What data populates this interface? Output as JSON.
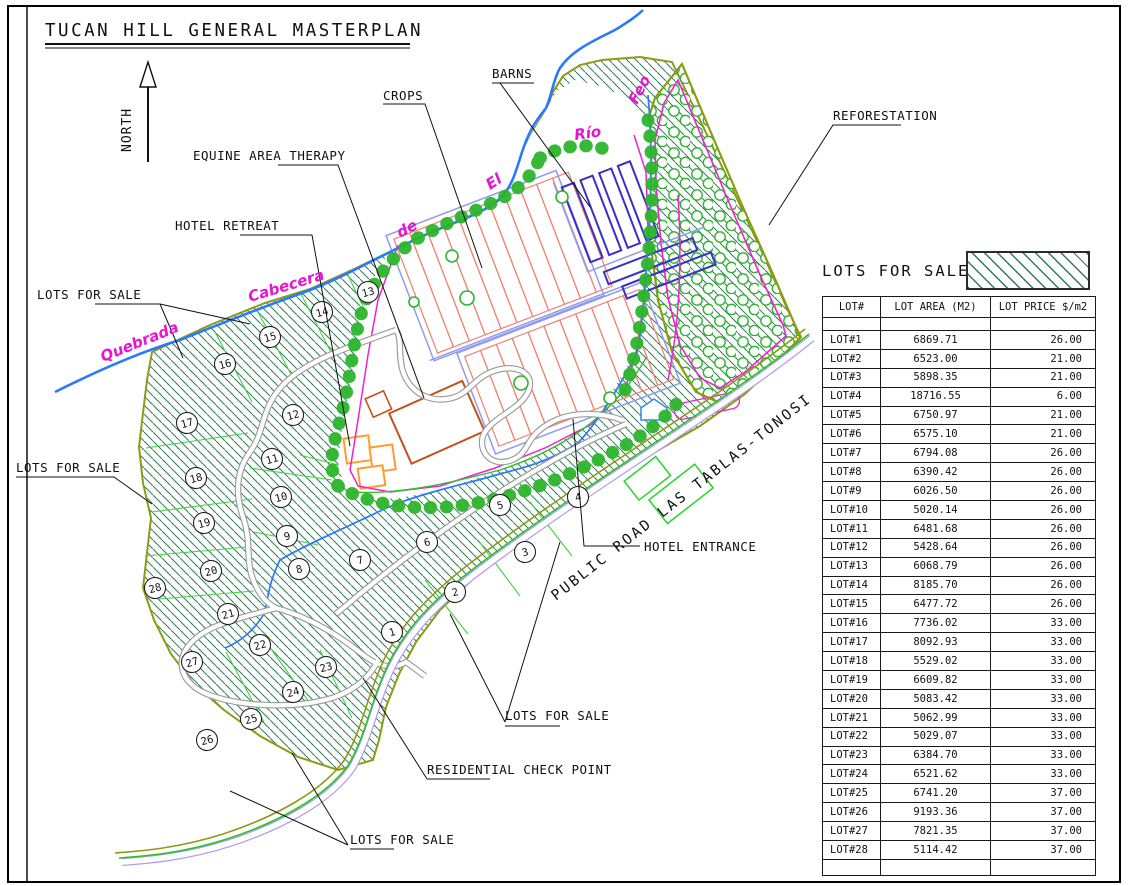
{
  "title": "TUCAN HILL GENERAL MASTERPLAN",
  "map": {
    "north": "NORTH",
    "labels": {
      "crops": "CROPS",
      "barns": "BARNS",
      "equine": "EQUINE AREA THERAPY",
      "hotel_retreat": "HOTEL RETREAT",
      "reforestation": "REFORESTATION",
      "lots_for_sale": "LOTS FOR SALE",
      "residential_check_point": "RESIDENTIAL CHECK POINT",
      "hotel_entrance": "HOTEL ENTRANCE",
      "public_road": "PUBLIC ROAD LAS TABLAS-TONOSI"
    },
    "river_words": {
      "quebrada": "Quebrada",
      "cabecera": "Cabecera",
      "de": "de",
      "el": "El",
      "rio": "Río",
      "feo": "Feo"
    },
    "lot_markers": [
      {
        "n": 1,
        "x": 392,
        "y": 632
      },
      {
        "n": 2,
        "x": 455,
        "y": 592
      },
      {
        "n": 3,
        "x": 525,
        "y": 552
      },
      {
        "n": 4,
        "x": 578,
        "y": 497
      },
      {
        "n": 5,
        "x": 500,
        "y": 505
      },
      {
        "n": 6,
        "x": 427,
        "y": 542
      },
      {
        "n": 7,
        "x": 360,
        "y": 560
      },
      {
        "n": 8,
        "x": 299,
        "y": 569
      },
      {
        "n": 9,
        "x": 287,
        "y": 536
      },
      {
        "n": 10,
        "x": 281,
        "y": 497
      },
      {
        "n": 11,
        "x": 272,
        "y": 459
      },
      {
        "n": 12,
        "x": 293,
        "y": 415
      },
      {
        "n": 13,
        "x": 368,
        "y": 292
      },
      {
        "n": 14,
        "x": 322,
        "y": 312
      },
      {
        "n": 15,
        "x": 270,
        "y": 337
      },
      {
        "n": 16,
        "x": 225,
        "y": 364
      },
      {
        "n": 17,
        "x": 187,
        "y": 423
      },
      {
        "n": 18,
        "x": 196,
        "y": 478
      },
      {
        "n": 19,
        "x": 204,
        "y": 523
      },
      {
        "n": 20,
        "x": 211,
        "y": 571
      },
      {
        "n": 21,
        "x": 228,
        "y": 614
      },
      {
        "n": 22,
        "x": 260,
        "y": 645
      },
      {
        "n": 23,
        "x": 326,
        "y": 667
      },
      {
        "n": 24,
        "x": 293,
        "y": 692
      },
      {
        "n": 25,
        "x": 251,
        "y": 719
      },
      {
        "n": 26,
        "x": 207,
        "y": 740
      },
      {
        "n": 27,
        "x": 192,
        "y": 662
      },
      {
        "n": 28,
        "x": 155,
        "y": 588
      }
    ]
  },
  "legend": {
    "title": "LOTS FOR SALE"
  },
  "table": {
    "columns": [
      "LOT#",
      "LOT AREA (M2)",
      "LOT PRICE $/m2"
    ],
    "rows": [
      {
        "lot": "LOT#1",
        "area": "6869.71",
        "price": "26.00"
      },
      {
        "lot": "LOT#2",
        "area": "6523.00",
        "price": "21.00"
      },
      {
        "lot": "LOT#3",
        "area": "5898.35",
        "price": "21.00"
      },
      {
        "lot": "LOT#4",
        "area": "18716.55",
        "price": "6.00"
      },
      {
        "lot": "LOT#5",
        "area": "6750.97",
        "price": "21.00"
      },
      {
        "lot": "LOT#6",
        "area": "6575.10",
        "price": "21.00"
      },
      {
        "lot": "LOT#7",
        "area": "6794.08",
        "price": "26.00"
      },
      {
        "lot": "LOT#8",
        "area": "6390.42",
        "price": "26.00"
      },
      {
        "lot": "LOT#9",
        "area": "6026.50",
        "price": "26.00"
      },
      {
        "lot": "LOT#10",
        "area": "5020.14",
        "price": "26.00"
      },
      {
        "lot": "LOT#11",
        "area": "6481.68",
        "price": "26.00"
      },
      {
        "lot": "LOT#12",
        "area": "5428.64",
        "price": "26.00"
      },
      {
        "lot": "LOT#13",
        "area": "6068.79",
        "price": "26.00"
      },
      {
        "lot": "LOT#14",
        "area": "8185.70",
        "price": "26.00"
      },
      {
        "lot": "LOT#15",
        "area": "6477.72",
        "price": "26.00"
      },
      {
        "lot": "LOT#16",
        "area": "7736.02",
        "price": "33.00"
      },
      {
        "lot": "LOT#17",
        "area": "8092.93",
        "price": "33.00"
      },
      {
        "lot": "LOT#18",
        "area": "5529.02",
        "price": "33.00"
      },
      {
        "lot": "LOT#19",
        "area": "6609.82",
        "price": "33.00"
      },
      {
        "lot": "LOT#20",
        "area": "5083.42",
        "price": "33.00"
      },
      {
        "lot": "LOT#21",
        "area": "5062.99",
        "price": "33.00"
      },
      {
        "lot": "LOT#22",
        "area": "5029.07",
        "price": "33.00"
      },
      {
        "lot": "LOT#23",
        "area": "6384.70",
        "price": "33.00"
      },
      {
        "lot": "LOT#24",
        "area": "6521.62",
        "price": "33.00"
      },
      {
        "lot": "LOT#25",
        "area": "6741.20",
        "price": "37.00"
      },
      {
        "lot": "LOT#26",
        "area": "9193.36",
        "price": "37.00"
      },
      {
        "lot": "LOT#27",
        "area": "7821.35",
        "price": "37.00"
      },
      {
        "lot": "LOT#28",
        "area": "5114.42",
        "price": "37.00"
      }
    ]
  },
  "colors": {
    "hatch_green": "#2e7d57",
    "lot_boundary_green": "#3fd23f",
    "site_olive": "#8d9b13",
    "river_blue": "#2979ff",
    "river_label_magenta": "#e615d2",
    "fence_magenta": "#f51fd2",
    "crops_salmon": "#ef8372",
    "barns_blue": "#3a30c5",
    "walkway_periwinkle": "#8f9bee",
    "hotel_orange": "#ff9c2e",
    "building_brick": "#c3511d",
    "tree_green": "#2db52d",
    "road_gray": "#9a9a9a",
    "public_road_purple": "#b199f0"
  }
}
